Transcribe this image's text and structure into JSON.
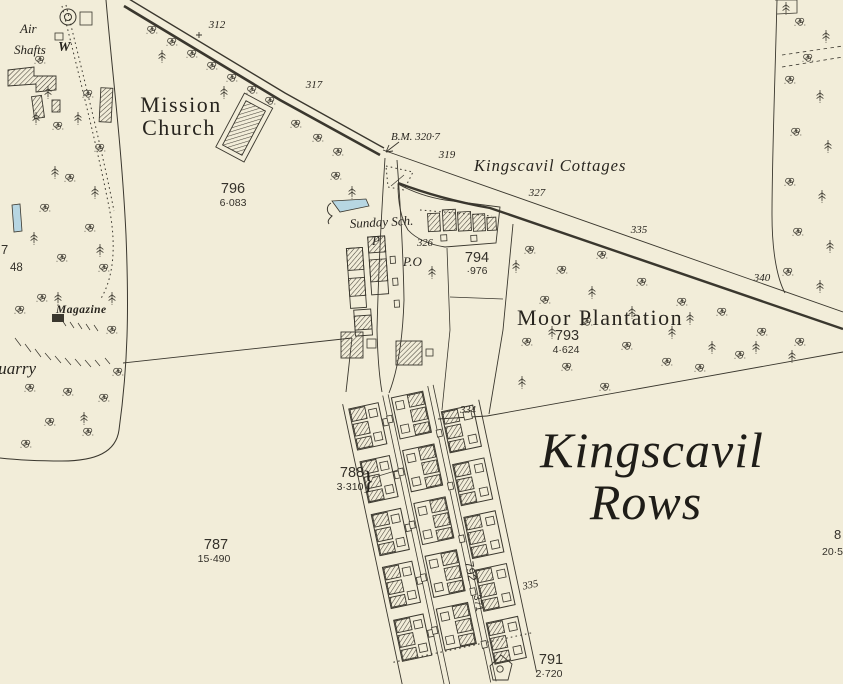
{
  "map": {
    "colors": {
      "paper": "#f2edd9",
      "ink": "#3a372e",
      "text": "#28251f",
      "water": "#b7d6e2",
      "hatch": "#49453b"
    },
    "labels": {
      "air1": "Air",
      "air2": "Shafts",
      "w_mark": "W",
      "mission1": "Mission",
      "mission2": "Church",
      "n312": "312",
      "n317": "317",
      "bm": "B.M. 320·7",
      "n319": "319",
      "cottages": "Kingscavil  Cottages",
      "n327": "327",
      "n335": "335",
      "n340": "340",
      "p796": "796",
      "a796": "6·083",
      "sunday": "Sunday Sch.",
      "p_mark": "P",
      "po_mark": "P.O",
      "n326": "326",
      "p794": "794",
      "a794": "·976",
      "moor": "Moor  Plantation",
      "p793": "793",
      "a793": "4·624",
      "magazine": "Magazine",
      "quarry": "Quarry",
      "n334": "334",
      "n335b": "335",
      "rows1": "Kingscavil",
      "rows2": "Rows",
      "p788": "788",
      "a788": "3·310",
      "brace": "}",
      "p787": "787",
      "a787": "15·490",
      "p791": "791",
      "a791": "2·720",
      "p792": "792",
      "a792": "·371",
      "edge7": "7",
      "edge48": "48",
      "edge8": "8",
      "edge205": "20·5"
    }
  }
}
